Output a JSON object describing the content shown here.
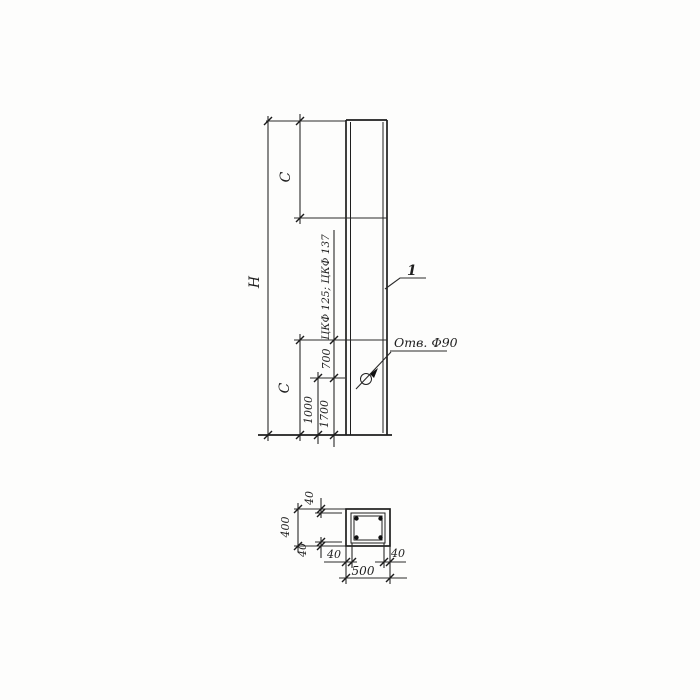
{
  "drawing": {
    "ink_color": "#1e1e1e",
    "paper_color": "#fdfdfc",
    "elevation": {
      "overall_height_label": "H",
      "top_segment_label": "C",
      "bottom_segment_label": "C",
      "dim_1700": "1700",
      "dim_1000": "1000",
      "dim_700": "700",
      "series_note": "ЦКФ 125; ЦКФ 137",
      "position_marker": "1",
      "hole_label": "Отв. Ф90"
    },
    "section": {
      "overall_height": "400",
      "overall_width": "500",
      "cover_top": "40",
      "cover_bottom": "40",
      "cover_left": "40",
      "cover_right": "40"
    }
  }
}
